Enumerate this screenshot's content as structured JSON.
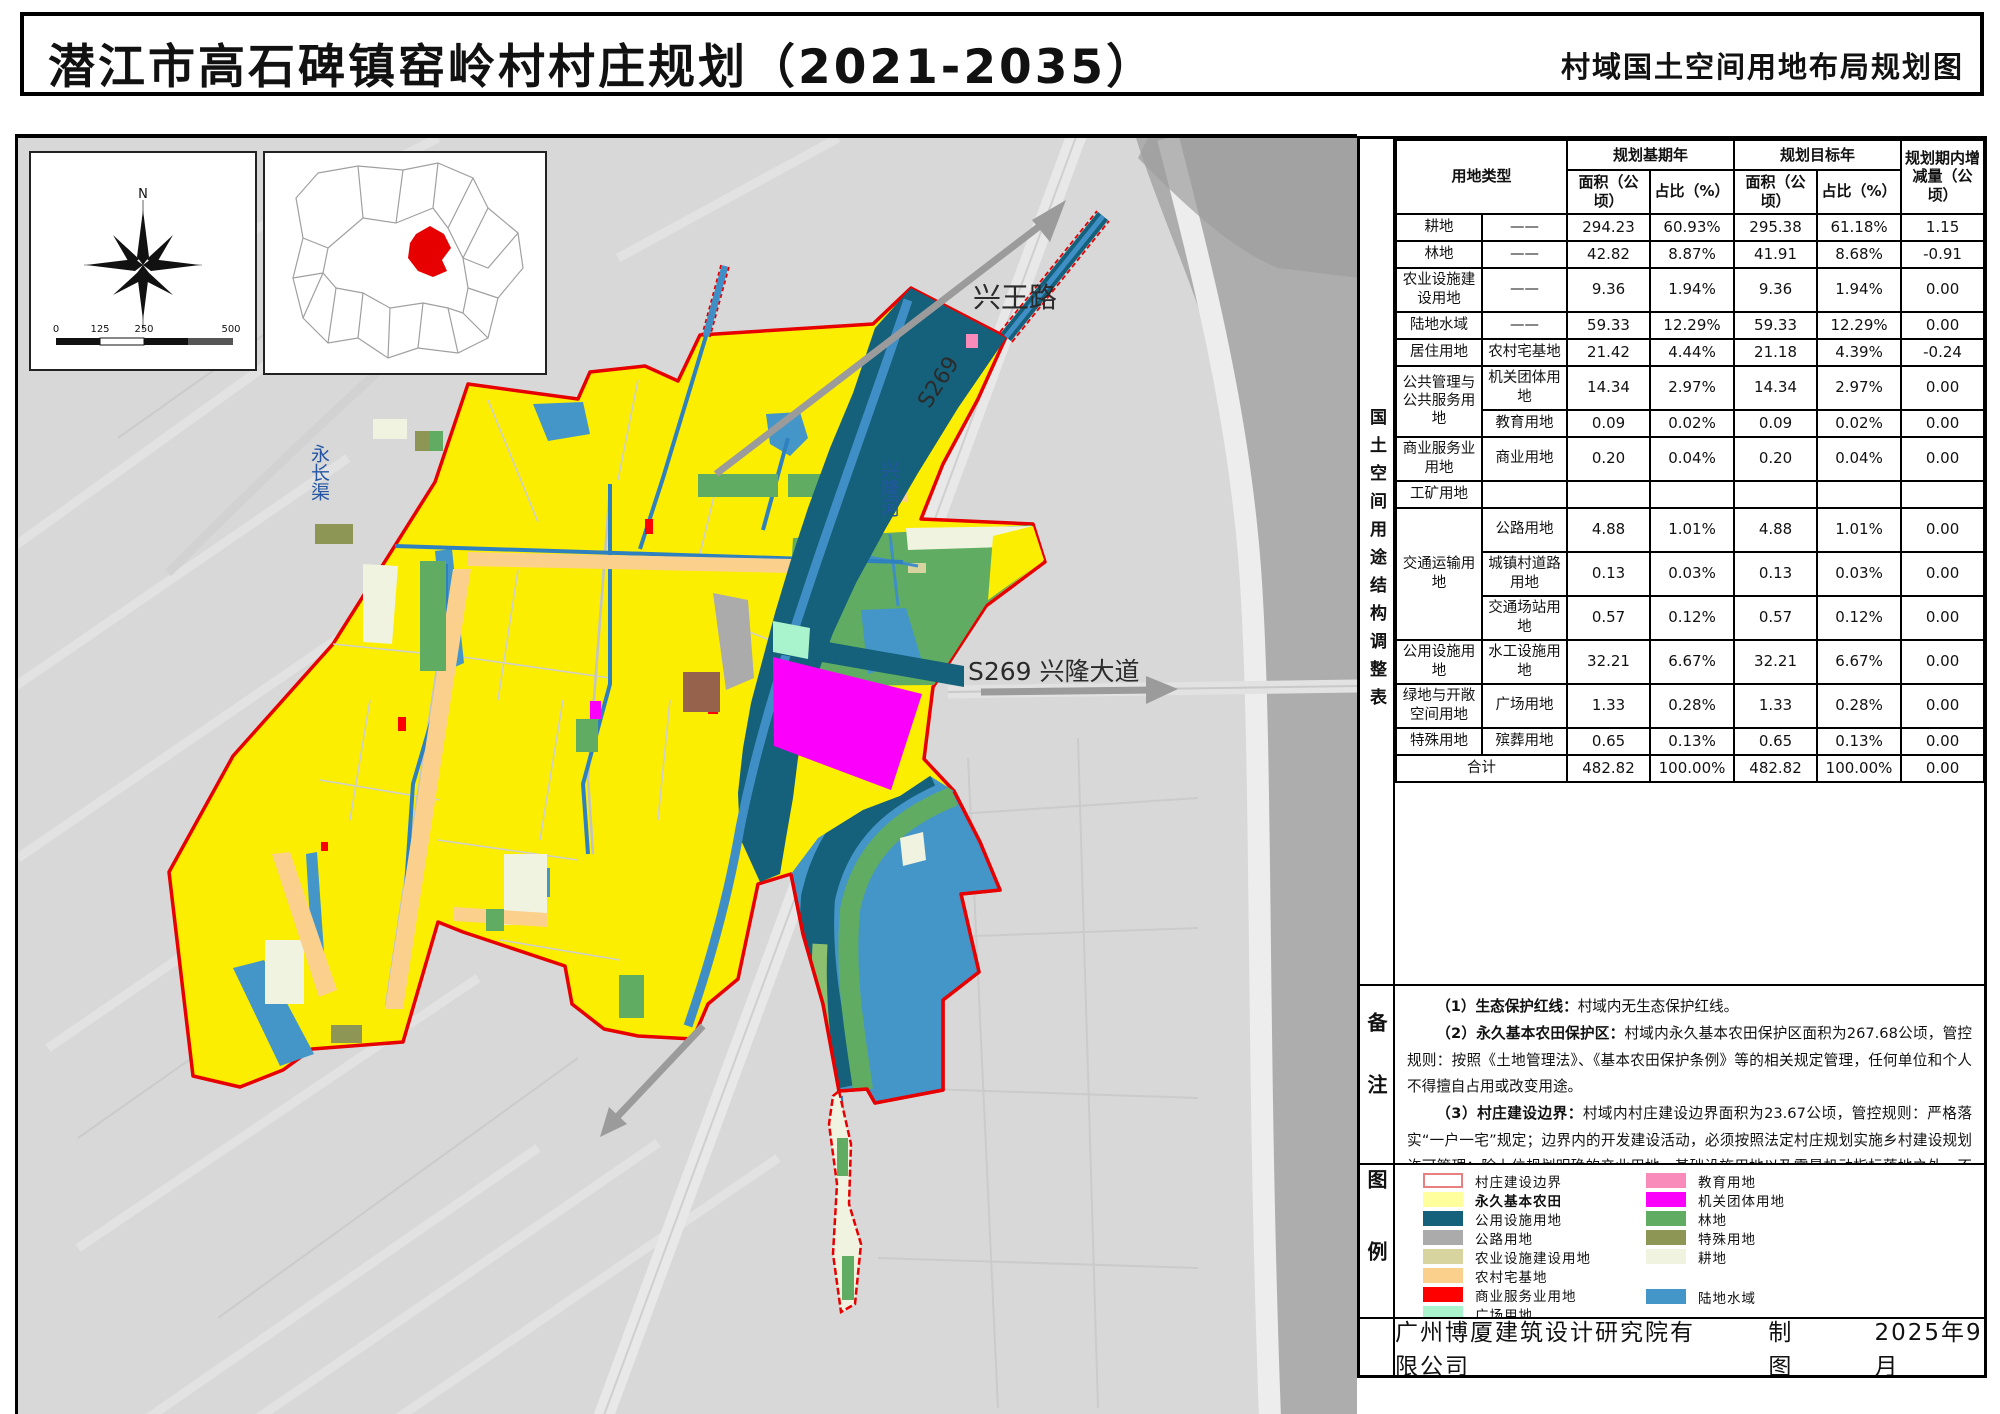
{
  "title": "潜江市高石碑镇窑岭村村庄规划（2021-2035）",
  "subtitle": "村域国土空间用地布局规划图",
  "map": {
    "compass_n": "N",
    "scale_ticks": [
      "0",
      "125",
      "250",
      "500"
    ],
    "labels": {
      "road_ne": "兴王路",
      "road_code": "S269",
      "river": "兴隆河",
      "canal_west": "永长渠",
      "road_east": "S269 兴隆大道"
    }
  },
  "panel": {
    "table_section_title": "国土空间用途结构调整表",
    "notes_section_title": "备注",
    "legend_section_title": "图例"
  },
  "table": {
    "header": {
      "land_type": "用地类型",
      "base_year": "规划基期年",
      "target_year": "规划目标年",
      "change": "规划期内增减量（公顷）",
      "area": "面积（公顷）",
      "ratio": "占比（%）"
    },
    "rows": [
      {
        "cat": "耕地",
        "span": 1,
        "sub": "——",
        "v": [
          "294.23",
          "60.93%",
          "295.38",
          "61.18%",
          "1.15"
        ]
      },
      {
        "cat": "林地",
        "span": 1,
        "sub": "——",
        "v": [
          "42.82",
          "8.87%",
          "41.91",
          "8.68%",
          "-0.91"
        ]
      },
      {
        "cat": "农业设施建设用地",
        "span": 1,
        "sub": "——",
        "v": [
          "9.36",
          "1.94%",
          "9.36",
          "1.94%",
          "0.00"
        ]
      },
      {
        "cat": "陆地水域",
        "span": 1,
        "sub": "——",
        "v": [
          "59.33",
          "12.29%",
          "59.33",
          "12.29%",
          "0.00"
        ]
      },
      {
        "cat": "居住用地",
        "span": 1,
        "sub": "农村宅基地",
        "v": [
          "21.42",
          "4.44%",
          "21.18",
          "4.39%",
          "-0.24"
        ]
      },
      {
        "cat": "公共管理与公共服务用地",
        "span": 2,
        "sub": "机关团体用地",
        "v": [
          "14.34",
          "2.97%",
          "14.34",
          "2.97%",
          "0.00"
        ]
      },
      {
        "sub": "教育用地",
        "v": [
          "0.09",
          "0.02%",
          "0.09",
          "0.02%",
          "0.00"
        ]
      },
      {
        "cat": "商业服务业用地",
        "span": 1,
        "sub": "商业用地",
        "v": [
          "0.20",
          "0.04%",
          "0.20",
          "0.04%",
          "0.00"
        ]
      },
      {
        "cat": "工矿用地",
        "span": 1,
        "sub": "",
        "v": [
          "",
          "",
          "",
          "",
          ""
        ]
      },
      {
        "cat": "交通运输用地",
        "span": 3,
        "sub": "公路用地",
        "v": [
          "4.88",
          "1.01%",
          "4.88",
          "1.01%",
          "0.00"
        ]
      },
      {
        "sub": "城镇村道路用地",
        "v": [
          "0.13",
          "0.03%",
          "0.13",
          "0.03%",
          "0.00"
        ]
      },
      {
        "sub": "交通场站用地",
        "v": [
          "0.57",
          "0.12%",
          "0.57",
          "0.12%",
          "0.00"
        ]
      },
      {
        "cat": "公用设施用地",
        "span": 1,
        "sub": "水工设施用地",
        "v": [
          "32.21",
          "6.67%",
          "32.21",
          "6.67%",
          "0.00"
        ]
      },
      {
        "cat": "绿地与开敞空间用地",
        "span": 1,
        "sub": "广场用地",
        "v": [
          "1.33",
          "0.28%",
          "1.33",
          "0.28%",
          "0.00"
        ]
      },
      {
        "cat": "特殊用地",
        "span": 1,
        "sub": "殡葬用地",
        "v": [
          "0.65",
          "0.13%",
          "0.65",
          "0.13%",
          "0.00"
        ]
      }
    ],
    "total": {
      "label": "合计",
      "v": [
        "482.82",
        "100.00%",
        "482.82",
        "100.00%",
        "0.00"
      ]
    }
  },
  "notes": {
    "items": [
      {
        "label": "（1）生态保护红线：",
        "text": "村域内无生态保护红线。"
      },
      {
        "label": "（2）永久基本农田保护区：",
        "text": "村域内永久基本农田保护区面积为267.68公顷，管控规则：按照《土地管理法》、《基本农田保护条例》等的相关规定管理，任何单位和个人不得擅自占用或改变用途。"
      },
      {
        "label": "（3）村庄建设边界：",
        "text": "村域内村庄建设边界面积为23.67公顷，管控规则：严格落实“一户一宅”规定；边界内的开发建设活动，必须按照法定村庄规划实施乡村建设规划许可管理；除上位规划明确的产业用地、基础设施用地以及零星机动指标落地之外，不得在村庄建设边界外新增建设用地；确需修改规划的，严格按程序报原规划审批机关。"
      }
    ]
  },
  "legend": {
    "col1": [
      {
        "label": "村庄建设边界",
        "color": "#FFFFFF",
        "border": "#E88080"
      },
      {
        "label": "永久基本农田",
        "color": "#FFFF9E",
        "bold": true
      },
      {
        "label": "公用设施用地",
        "color": "#15607A"
      },
      {
        "label": "公路用地",
        "color": "#ABABAB"
      },
      {
        "label": "农业设施建设用地",
        "color": "#D8D4A0"
      },
      {
        "label": "农村宅基地",
        "color": "#FBD08C"
      },
      {
        "label": "商业服务业用地",
        "color": "#FE0000"
      },
      {
        "label": "广场用地",
        "color": "#A9F3CD"
      }
    ],
    "col2": [
      {
        "label": "教育用地",
        "color": "#F98BBB"
      },
      {
        "label": "机关团体用地",
        "color": "#FB00FB"
      },
      {
        "label": "林地",
        "color": "#5FAC62"
      },
      {
        "label": "特殊用地",
        "color": "#8E9655"
      },
      {
        "label": "耕地",
        "color": "#EFF3DF"
      },
      {
        "label": "陆地水域",
        "color": "#4596C8",
        "gap_before": true
      }
    ]
  },
  "footer": {
    "company": "广州博厦建筑设计研究院有限公司",
    "drafted_by": "制图",
    "date": "2025年9月"
  },
  "colors": {
    "boundary_red": "#E60000",
    "farmland_yellow": "#FCEE00",
    "utility_teal": "#15607A",
    "water_blue": "#4596C8"
  }
}
